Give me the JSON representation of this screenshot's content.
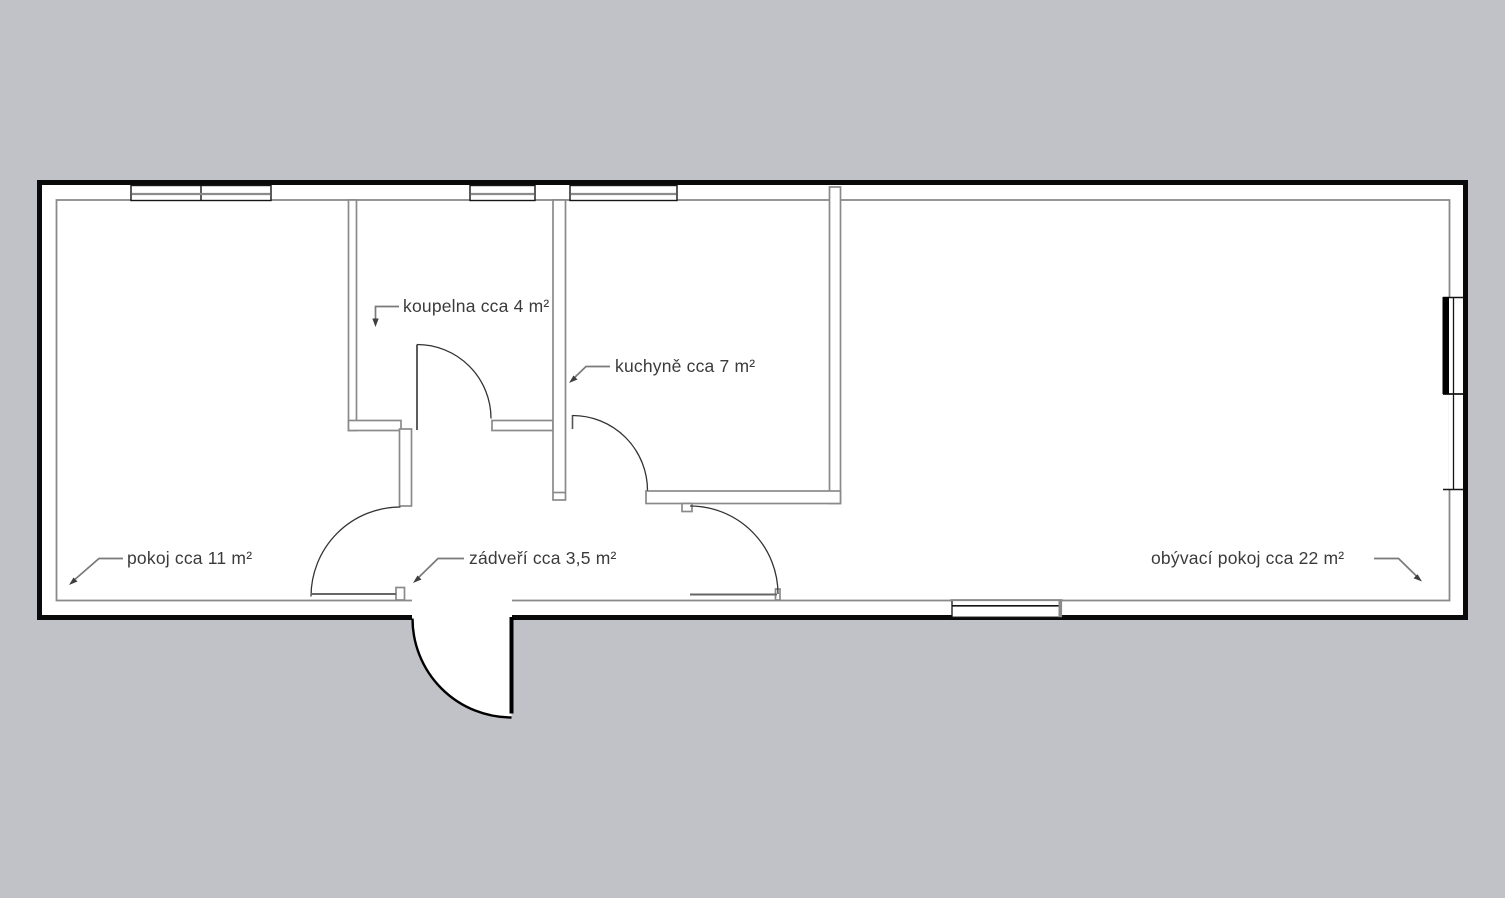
{
  "plan": {
    "rooms": {
      "pokoj": {
        "label": "pokoj cca 11 m²"
      },
      "koupelna": {
        "label": "koupelna cca 4 m²"
      },
      "kuchyne": {
        "label": "kuchyně cca 7 m²"
      },
      "zadveri": {
        "label": "zádveří cca 3,5 m²"
      },
      "obyvaci_pokoj": {
        "label": "obývací pokoj cca 22 m²"
      }
    },
    "colors": {
      "background": "#c0c2c8",
      "floor": "#ffffff",
      "exterior_wall": "#0a0a0a",
      "interior_wall": "#8a8a8a",
      "window_frame": "#151515",
      "leader_line": "#7a7a7a",
      "text": "#3b3b3b"
    }
  }
}
